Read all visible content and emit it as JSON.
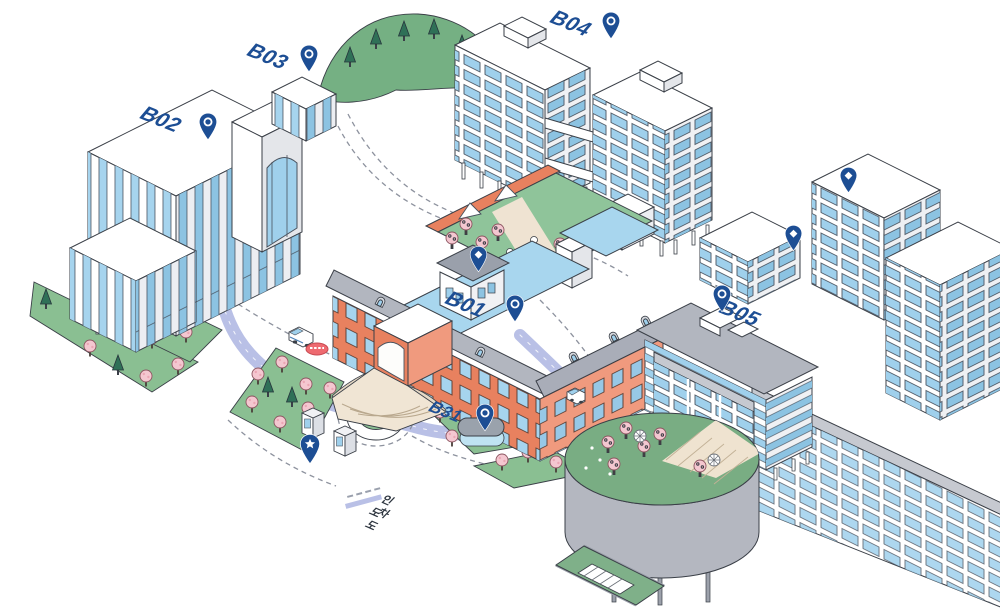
{
  "buildings": {
    "b01": {
      "label": "B01"
    },
    "b02": {
      "label": "B02"
    },
    "b03": {
      "label": "B03"
    },
    "b04": {
      "label": "B04"
    },
    "b05": {
      "label": "B05"
    },
    "b31": {
      "label": "B31"
    }
  },
  "pins": {
    "labeled_buildings": [
      "B01",
      "B02",
      "B03",
      "B04",
      "B05",
      "B31"
    ],
    "labeled_icon": "circle-outline",
    "facility_icon": "diamond",
    "facility_pin_count": 3,
    "landmark_icon": "star",
    "landmark_pin_count": 1
  },
  "legend": {
    "items": [
      {
        "label": "인도",
        "line": "dashed"
      },
      {
        "label": "차도",
        "line": "solid"
      }
    ]
  },
  "colors": {
    "pin_navy": "#1d4e94",
    "road_lavender": "#b9c0e6",
    "path_gray": "#8d929e",
    "brick_salmon": "#e8815f",
    "window_blue": "#9fd0ec",
    "lawn_green": "#8abf92",
    "pine_green": "#2f7057",
    "blossom_pink": "#f4c7d0",
    "roof_gray": "#b2b6bf",
    "roof_blue": "#a8d6ee",
    "stop_red": "#ee6a70"
  }
}
